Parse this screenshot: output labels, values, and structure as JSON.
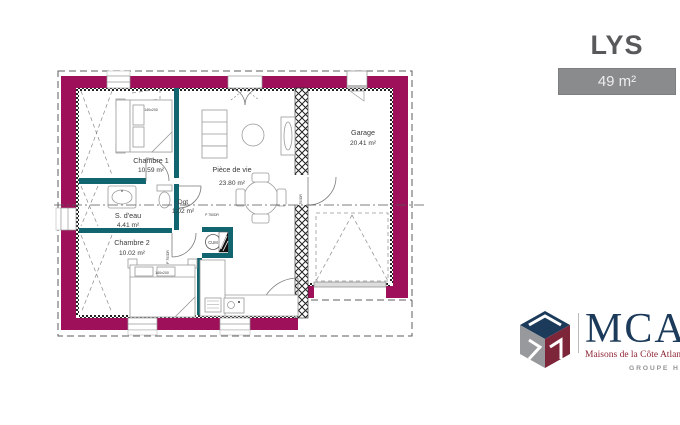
{
  "header": {
    "title": "LYS",
    "area_badge": "49 m²"
  },
  "rooms": {
    "chambre1": {
      "name": "Chambre 1",
      "area": "10.59 m²"
    },
    "sdeau": {
      "name": "S. d'eau",
      "area": "4.41 m²"
    },
    "chambre2": {
      "name": "Chambre 2",
      "area": "10.02 m²"
    },
    "dgt": {
      "name": "Dgt",
      "area": "1.02 m²"
    },
    "sejour": {
      "name": "Pièce de vie",
      "area": "23.80 m²"
    },
    "garage": {
      "name": "Garage",
      "area": "20.41 m²"
    }
  },
  "annotations": {
    "bed_size": "140x200",
    "door_ref": "P 750DR",
    "water_heater": "CUM"
  },
  "branding": {
    "name": "MCA",
    "subtitle": "Maisons de la Côte Atlantique",
    "group": "GROUPE HEXAÔM"
  },
  "colors": {
    "exterior_wall": "#9E115A",
    "partition_wall": "#10656E",
    "title_gray": "#58595B",
    "badge_bg": "#8A8B8D",
    "logo_navy": "#1C3B5A",
    "logo_maroon": "#7E2639",
    "logo_gray": "#97999C"
  }
}
